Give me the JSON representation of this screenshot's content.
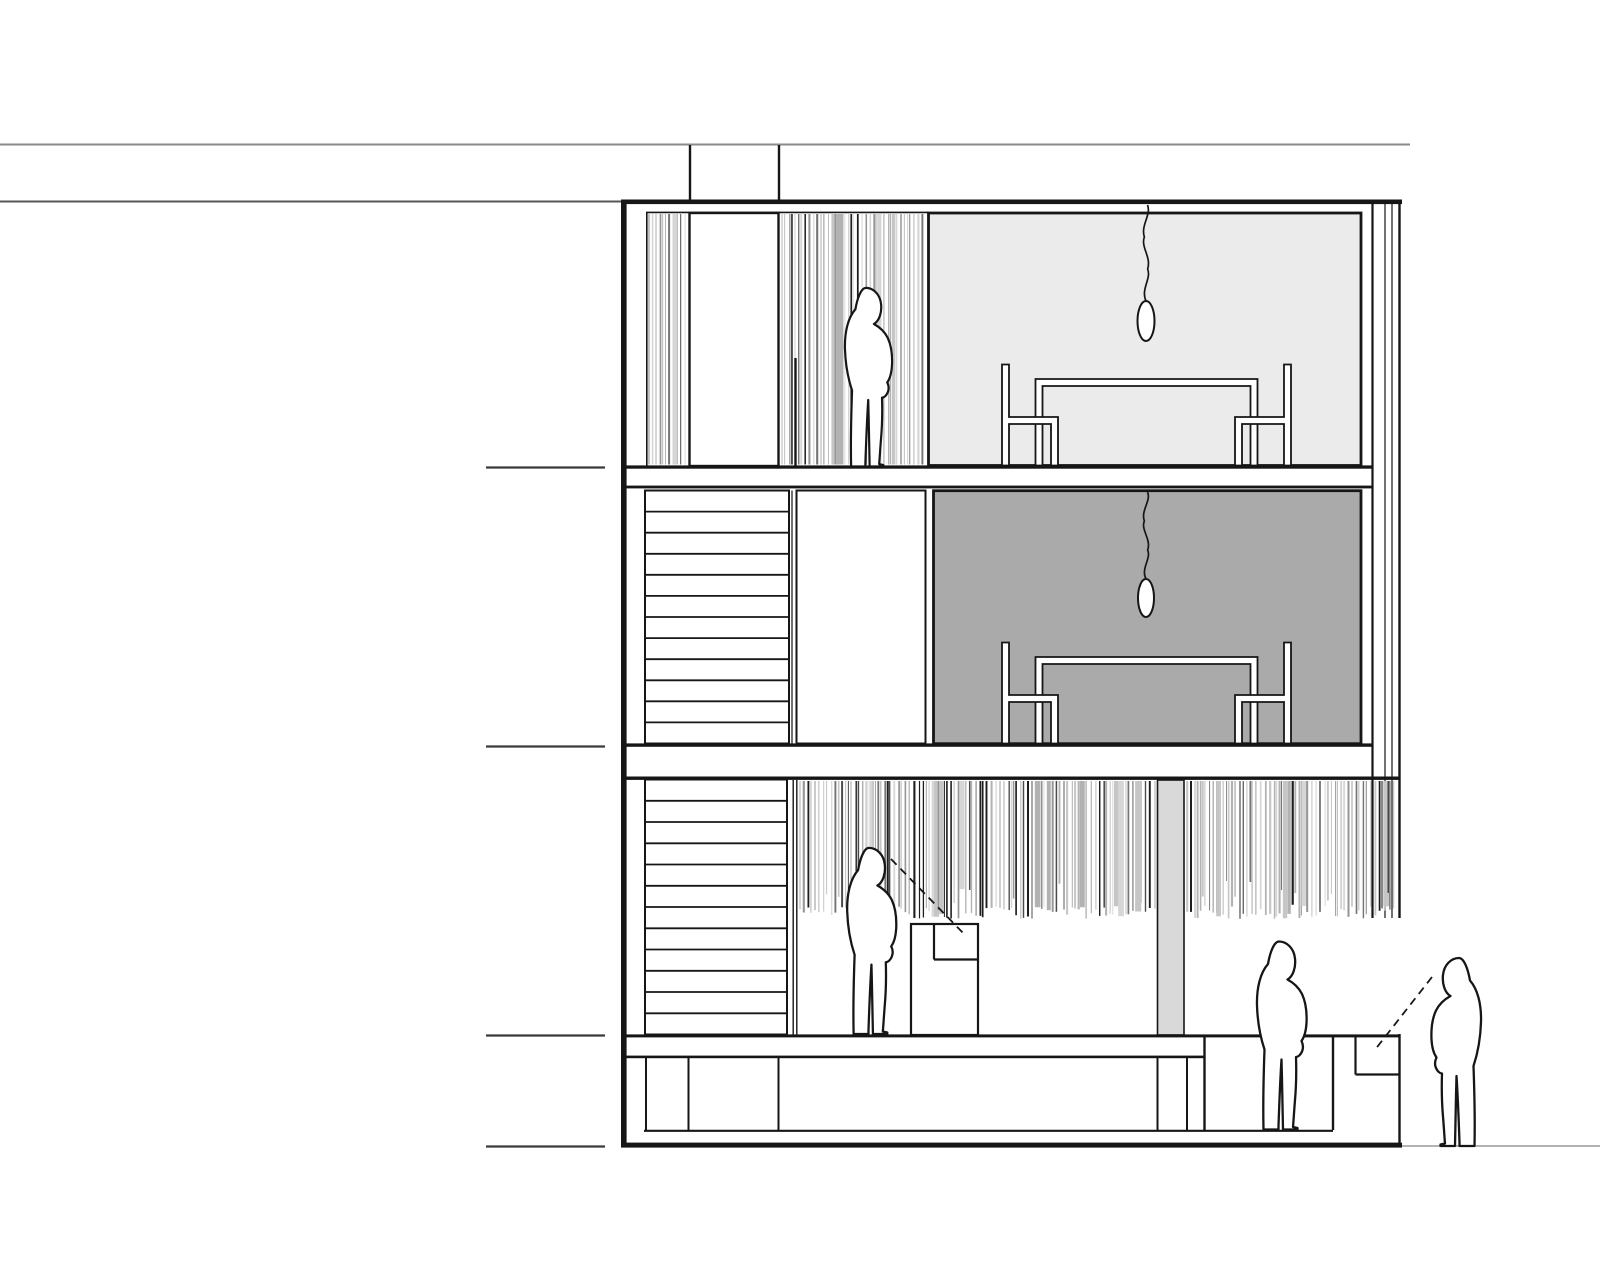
{
  "meta": {
    "title": "Building cross-section drawing",
    "aria_label": "Black and white architectural section drawing of a three-storey building with curtain hatching, stairs, dining furniture, pendant lamps and four human silhouettes"
  },
  "colors": {
    "paper": "#ffffff",
    "ink": "#161616",
    "ink_soft": "#3a3a3a",
    "site_line": "#8a8a8a",
    "ground_line": "#9a9a9a",
    "room_light": "#ebebeb",
    "room_dark": "#aaaaaa",
    "column_gray": "#d9d9d9"
  },
  "hatch": {
    "palette": [
      "#d6d6d6",
      "#c6c6c6",
      "#b2b2b2",
      "#969696",
      "#757575",
      "#4a4a4a",
      "#1d1d1d"
    ],
    "regions": [
      {
        "name": "upper-left",
        "seed": 11,
        "x0": 649,
        "x1": 686,
        "y0": 214,
        "y1": 464.5,
        "min_gap": 1.6,
        "var_gap": 3.4,
        "wide_chance": 0.08,
        "dark_bias": 1.9
      },
      {
        "name": "upper-right",
        "seed": 23,
        "x0": 782,
        "x1": 925,
        "y0": 214,
        "y1": 464.5,
        "min_gap": 1.6,
        "var_gap": 3.4,
        "wide_chance": 0.08,
        "dark_bias": 1.9
      },
      {
        "name": "ground",
        "seed": 37,
        "x0": 800,
        "x1": 1396,
        "y0": 781,
        "y1": 919,
        "min_gap": 1.7,
        "var_gap": 3.6,
        "wide_chance": 0.07,
        "dark_bias": 1.25,
        "ragged": {
          "base": 919,
          "jitter": 13,
          "short_chance": 0.12,
          "short_extra": 28
        }
      }
    ]
  },
  "stairs": [
    {
      "name": "first-floor-stair",
      "x0": 645,
      "x1": 789,
      "y0": 490.5,
      "y1": 743.5,
      "steps": 12
    },
    {
      "name": "ground-floor-stair",
      "x0": 645,
      "x1": 787,
      "y0": 779.5,
      "y1": 1034.5,
      "steps": 12
    }
  ],
  "figures": [
    {
      "name": "figure-second-floor",
      "x": 863,
      "y": 466.5,
      "scale": 0.95,
      "flip": false
    },
    {
      "name": "figure-ground-floor",
      "x": 866,
      "y": 1034,
      "scale": 0.99,
      "flip": false
    },
    {
      "name": "figure-courtyard",
      "x": 1276,
      "y": 1129.5,
      "scale": 1.0,
      "flip": false
    },
    {
      "name": "figure-street",
      "x": 1462,
      "y": 1146,
      "scale": 1.0,
      "flip": true
    }
  ],
  "dining_sets": [
    {
      "name": "dining-set-second-floor",
      "x": 1146.5,
      "floor_y": 466.5
    },
    {
      "name": "dining-set-first-floor",
      "x": 1146.5,
      "floor_y": 744.5
    }
  ],
  "pendants": [
    {
      "name": "pendant-second-floor",
      "x": 1146,
      "top": 205,
      "bulb_cy": 321,
      "rx": 8.5,
      "ry": 20
    },
    {
      "name": "pendant-first-floor",
      "x": 1146,
      "top": 492,
      "bulb_cy": 598,
      "rx": 8,
      "ry": 19
    }
  ],
  "sight_lines": [
    {
      "name": "sight-line-interior",
      "x1": 891,
      "y1": 859,
      "x2": 966,
      "y2": 936
    },
    {
      "name": "sight-line-street",
      "x1": 1432,
      "y1": 977,
      "x2": 1374,
      "y2": 1051
    }
  ],
  "level_ticks": {
    "x0": 486,
    "x1": 605,
    "ys": [
      467.5,
      746.5,
      1035.5,
      1146.5
    ]
  }
}
